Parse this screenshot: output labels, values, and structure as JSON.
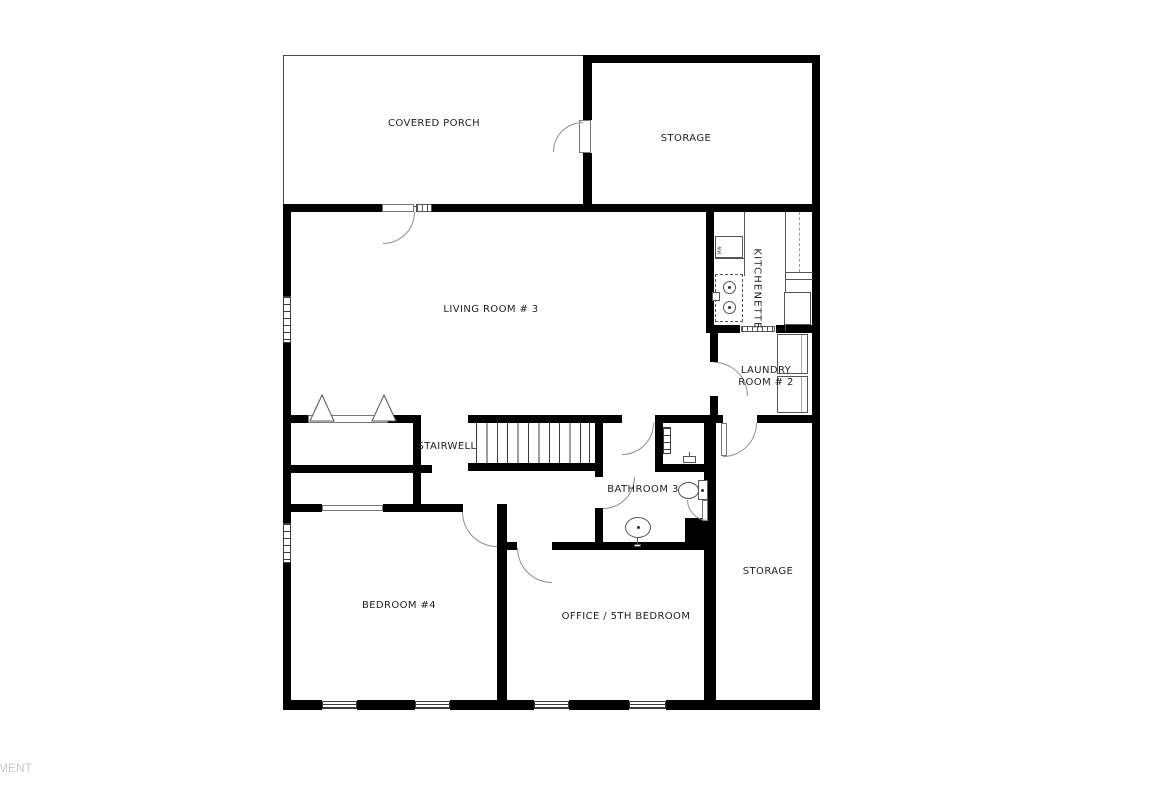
{
  "watermark": {
    "text": "MENT"
  },
  "plan": {
    "rooms": {
      "covered_porch": "COVERED PORCH",
      "storage_upper": "STORAGE",
      "living_room": "LIVING ROOM # 3",
      "kitchenette": "KITCHENETTE",
      "laundry": "LAUNDRY\nROOM # 2",
      "stairwell": "STAIRWELL",
      "bathroom": "BATHROOM 3",
      "bedroom4": "BEDROOM #4",
      "office": "OFFICE / 5TH BEDROOM",
      "storage_right": "STORAGE"
    },
    "fixtures": {
      "microwave": "MW"
    },
    "colors": {
      "wall": "#000000",
      "thin_line": "#555555",
      "door_arc": "#8f8f8f",
      "watermark": "#c9c9c9"
    }
  }
}
